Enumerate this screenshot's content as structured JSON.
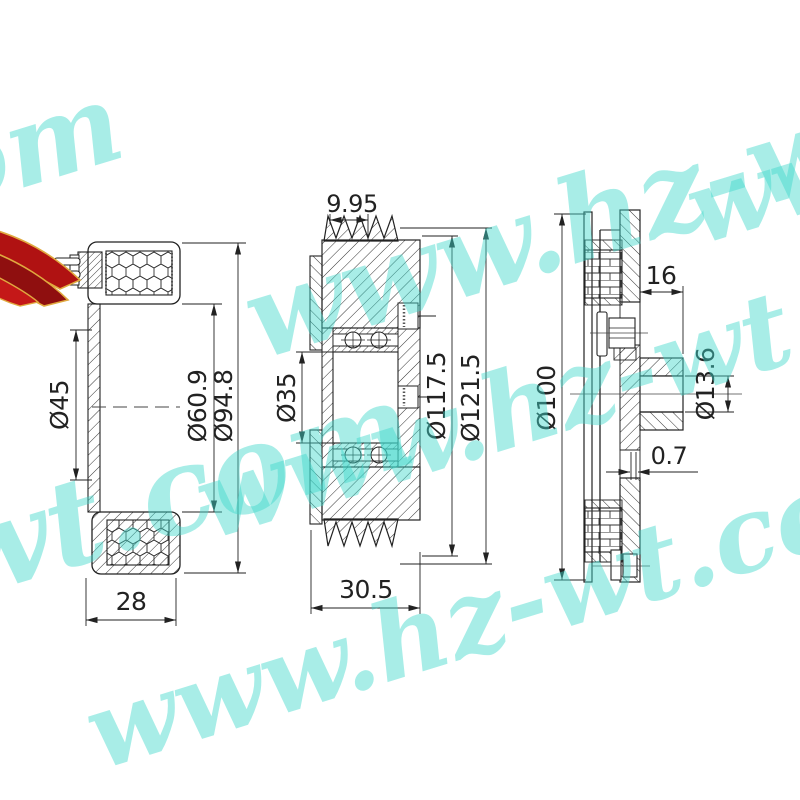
{
  "watermark": {
    "text": "www.hz-wt.com",
    "color": "#3fd9cc"
  },
  "colors": {
    "line": "#222222",
    "ribbon_red": "#b01212",
    "ribbon_dark_red": "#8f0f0f",
    "ribbon_gold": "#e0a93f"
  },
  "views": {
    "coil": {
      "dim_bore": "Ø45",
      "dim_coil_od": "Ø60.9",
      "dim_outer": "Ø94.8",
      "dim_width": "28"
    },
    "pulley": {
      "dim_groove": "9.95",
      "dim_bore": "Ø35",
      "dim_groove_od": "Ø117.5",
      "dim_od": "Ø121.5",
      "dim_width": "30.5"
    },
    "hub": {
      "dim_hub_len": "16",
      "dim_shaft": "Ø13.6",
      "dim_od": "Ø100",
      "dim_gap": "0.7"
    }
  }
}
